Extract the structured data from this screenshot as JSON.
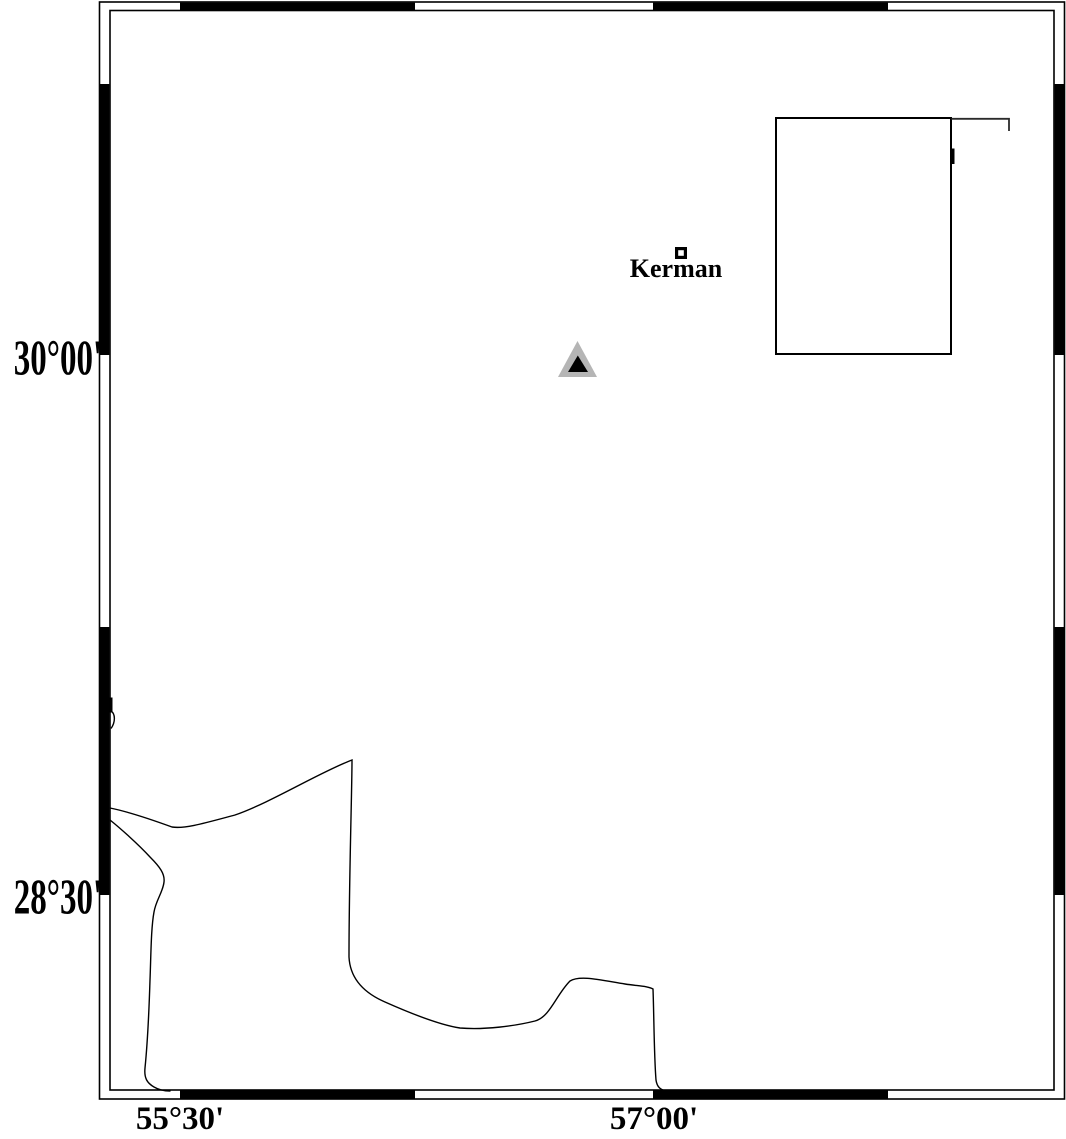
{
  "map": {
    "axis": {
      "left_labels": [
        {
          "text": "30°00'"
        },
        {
          "text": "28°30'"
        }
      ],
      "bottom_labels": [
        {
          "text": "55°30'"
        },
        {
          "text": "57°00'"
        }
      ]
    },
    "city": {
      "label": "Kerman"
    },
    "markers": {
      "city_square": {
        "shape": "hollow-square",
        "color": "#000000"
      },
      "triangle": {
        "outer_color": "#b5b5b5",
        "inner_color": "#000000"
      }
    },
    "colors": {
      "frame": "#000000",
      "contour": "#000000",
      "inset_fill": "#ffffff",
      "fragment_line": "#2b2b2b"
    }
  }
}
